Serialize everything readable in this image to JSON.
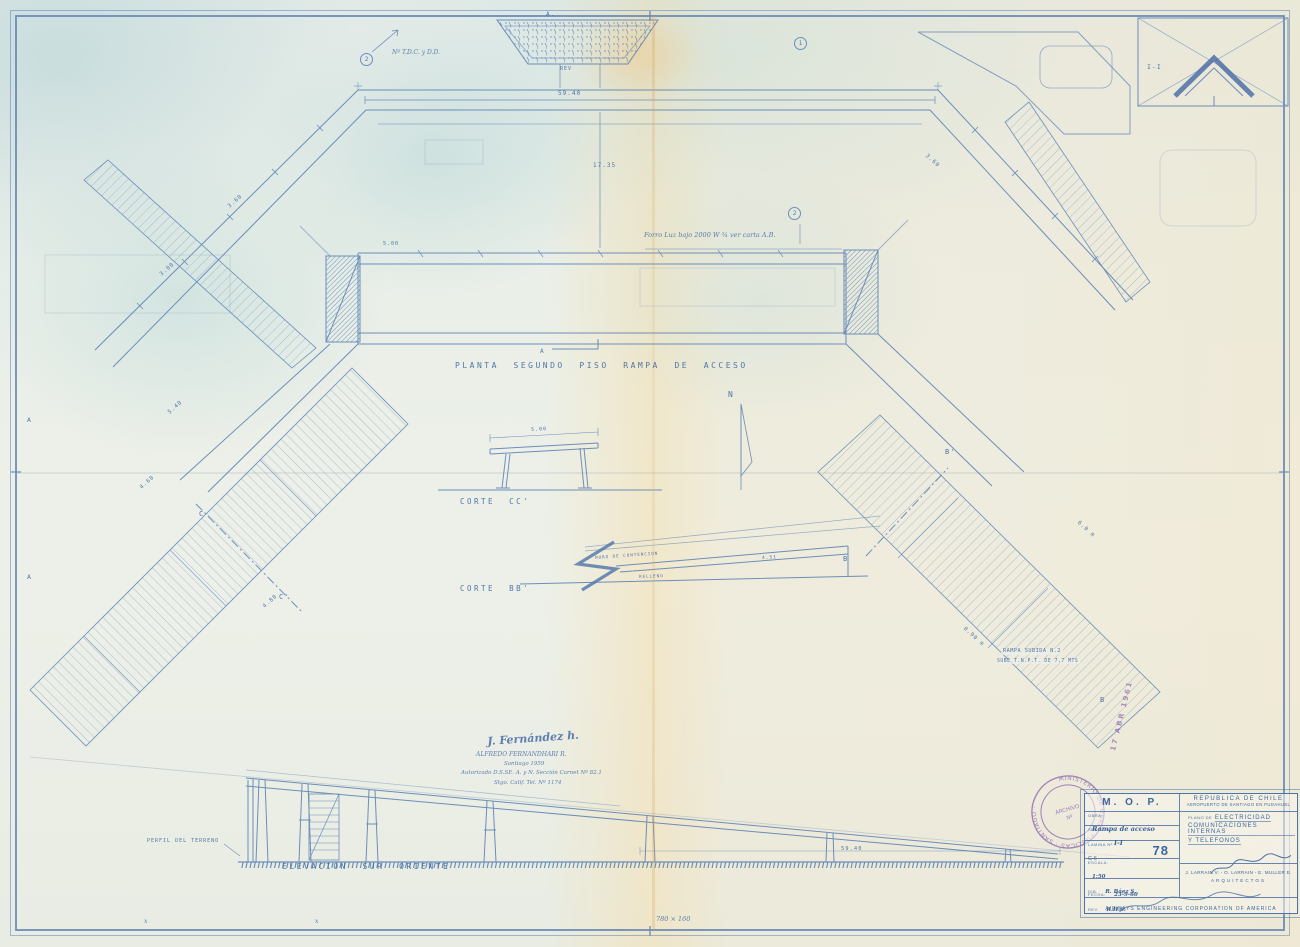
{
  "sheet": {
    "description": "Blueprint line drawing, second floor plan of an access ramp with sections and elevation"
  },
  "colors": {
    "line_blue": "#6286b6",
    "dark_blue": "#3c66a0",
    "hand_ink": "#4a6fa8",
    "stamp_purple": "#8a62ae",
    "paper": "#ecefe7"
  },
  "annotations": [
    {
      "text": "A.",
      "x": 546,
      "y": 12,
      "size": 6
    },
    {
      "text": "REV",
      "x": 560,
      "y": 67,
      "size": 5
    },
    {
      "text": "Nº T.D.C. y D.D.",
      "x": 392,
      "y": 50,
      "size": 6,
      "cls": "hand"
    },
    {
      "text": "2",
      "x": 360,
      "y": 53,
      "size": 6,
      "cls": "circled"
    },
    {
      "text": "1",
      "x": 794,
      "y": 37,
      "size": 6,
      "cls": "circled"
    },
    {
      "text": "2",
      "x": 788,
      "y": 207,
      "size": 6,
      "cls": "circled"
    },
    {
      "text": "59.40",
      "x": 558,
      "y": 91,
      "size": 6
    },
    {
      "text": "17.35",
      "x": 593,
      "y": 163,
      "size": 6
    },
    {
      "text": "5.00",
      "x": 383,
      "y": 242,
      "size": 5
    },
    {
      "text": "Forro Luz bajo 2000 W ¾ ver carta A.B.",
      "x": 644,
      "y": 232,
      "size": 6.5,
      "cls": "hand"
    },
    {
      "text": "3.60",
      "x": 227,
      "y": 205,
      "size": 5.5,
      "rot": -42
    },
    {
      "text": "3.00",
      "x": 159,
      "y": 273,
      "size": 5.5,
      "rot": -42
    },
    {
      "text": "5.40",
      "x": 167,
      "y": 411,
      "size": 5.5,
      "rot": -42
    },
    {
      "text": "4.60",
      "x": 139,
      "y": 486,
      "size": 5.5,
      "rot": -42
    },
    {
      "text": "4.80",
      "x": 262,
      "y": 605,
      "size": 5.5,
      "rot": -42
    },
    {
      "text": "3.60",
      "x": 928,
      "y": 153,
      "size": 5.5,
      "rot": 42
    },
    {
      "text": "6.0 m",
      "x": 1080,
      "y": 520,
      "size": 5.5,
      "rot": 42
    },
    {
      "text": "0.90 m",
      "x": 966,
      "y": 626,
      "size": 5.5,
      "rot": 42
    },
    {
      "text": "PLANTA  SEGUNDO  PISO  RAMPA  DE  ACCESO",
      "x": 455,
      "y": 362,
      "size": 8,
      "cls": "pl"
    },
    {
      "text": "A",
      "x": 540,
      "y": 349,
      "size": 6
    },
    {
      "text": "CORTE  CC'",
      "x": 460,
      "y": 498,
      "size": 7.5,
      "cls": "pl"
    },
    {
      "text": "5.00",
      "x": 531,
      "y": 428,
      "size": 5,
      "rot": -3
    },
    {
      "text": "N",
      "x": 728,
      "y": 391,
      "size": 8
    },
    {
      "text": "CORTE  BB'",
      "x": 460,
      "y": 585,
      "size": 7.5,
      "cls": "pl"
    },
    {
      "text": "MURO DE CONTENCION",
      "x": 595,
      "y": 556,
      "size": 4.2,
      "rot": -4
    },
    {
      "text": "RELLENO",
      "x": 639,
      "y": 575,
      "size": 4.2,
      "rot": -2
    },
    {
      "text": "4.51",
      "x": 762,
      "y": 557,
      "size": 4.5,
      "rot": -3
    },
    {
      "text": "C",
      "x": 199,
      "y": 511,
      "size": 7
    },
    {
      "text": "C'",
      "x": 279,
      "y": 594,
      "size": 7
    },
    {
      "text": "A",
      "x": 27,
      "y": 417,
      "size": 6.5
    },
    {
      "text": "A",
      "x": 27,
      "y": 574,
      "size": 6.5
    },
    {
      "text": "B'",
      "x": 945,
      "y": 449,
      "size": 7
    },
    {
      "text": "B",
      "x": 843,
      "y": 556,
      "size": 7
    },
    {
      "text": "B",
      "x": 1100,
      "y": 697,
      "size": 7
    },
    {
      "text": "RAMPA SUBIDA N.2",
      "x": 1001,
      "y": 649,
      "size": 5.2,
      "cls": "onband"
    },
    {
      "text": "SUBE T.N.P.T. DE 7,7 MTS",
      "x": 995,
      "y": 659,
      "size": 4.8,
      "cls": "onband"
    },
    {
      "text": "I-I",
      "x": 1147,
      "y": 64,
      "size": 6.5
    },
    {
      "text": "PERFIL DEL TERRENO",
      "x": 147,
      "y": 839,
      "size": 5
    },
    {
      "text": "ELEVACIÓN  SUR  ORIENTE",
      "x": 282,
      "y": 863,
      "size": 8,
      "cls": "pl"
    },
    {
      "text": "59.40",
      "x": 841,
      "y": 846,
      "size": 5.5
    },
    {
      "text": "J. Fernández h.",
      "x": 487,
      "y": 736,
      "size": 11,
      "rot": -4,
      "cls": "sig"
    },
    {
      "text": "ALFREDO FERNANDHARI R.",
      "x": 476,
      "y": 752,
      "size": 6,
      "cls": "hand"
    },
    {
      "text": "Santiago 1959",
      "x": 504,
      "y": 761,
      "size": 5.5,
      "cls": "hand"
    },
    {
      "text": "Autorizado D.S.SE. A. y N. Sección Carnet Nº 82.1",
      "x": 461,
      "y": 770,
      "size": 5.5,
      "cls": "hand"
    },
    {
      "text": "Stgo. Calif. Tel. Nº 1174",
      "x": 494,
      "y": 780,
      "size": 5.5,
      "cls": "hand"
    },
    {
      "text": "17 ABR 1961",
      "x": 1110,
      "y": 750,
      "size": 7,
      "rot": -76,
      "cls": "purple"
    },
    {
      "text": "780 × 160",
      "x": 656,
      "y": 916,
      "size": 6.5,
      "cls": "hand"
    },
    {
      "text": "x",
      "x": 144,
      "y": 919,
      "size": 6,
      "cls": "hand"
    },
    {
      "text": "x",
      "x": 315,
      "y": 919,
      "size": 6,
      "cls": "hand"
    }
  ],
  "title_block": {
    "mop": "M. O. P.",
    "country": "REPUBLICA DE CHILE",
    "airport": "AEROPUERTO DE SANTIAGO EN PUDAHUEL",
    "obra_label": "OBRA:",
    "obra_value": "Rampa de acceso",
    "plano_label": "PLANO DE",
    "plano_lines": [
      "ELECTRICIDAD",
      "COMUNICACIONES INTERNAS",
      "Y TELEFONOS"
    ],
    "seccion_label": "SECCION:",
    "seccion_value": "I-I",
    "lamina_label": "LAMINA Nº",
    "lamina_code": "C-6",
    "lamina_number": "78",
    "escala_label": "ESCALA:",
    "escala_value": "1:50",
    "fecha_label": "FECHA:",
    "fecha_value": "23-9-60",
    "dib_label": "DIB.",
    "dib_value": "R. Báez S.",
    "rev_label": "REV.",
    "rev_value": "R.H.S.",
    "architects": "J. LARRAIN V. - O. LARRAIN - E. MULLER E.",
    "architects_title": "ARQUITECTOS",
    "firm": "AIRWAYS ENGINEERING CORPORATION OF AMERICA"
  },
  "stamp": {
    "ring_text": "MINISTERIO DE OBRAS PUBLICAS · SANTIAGO ·",
    "center_line1": "ARCHIVO",
    "center_line2": "Nº"
  }
}
